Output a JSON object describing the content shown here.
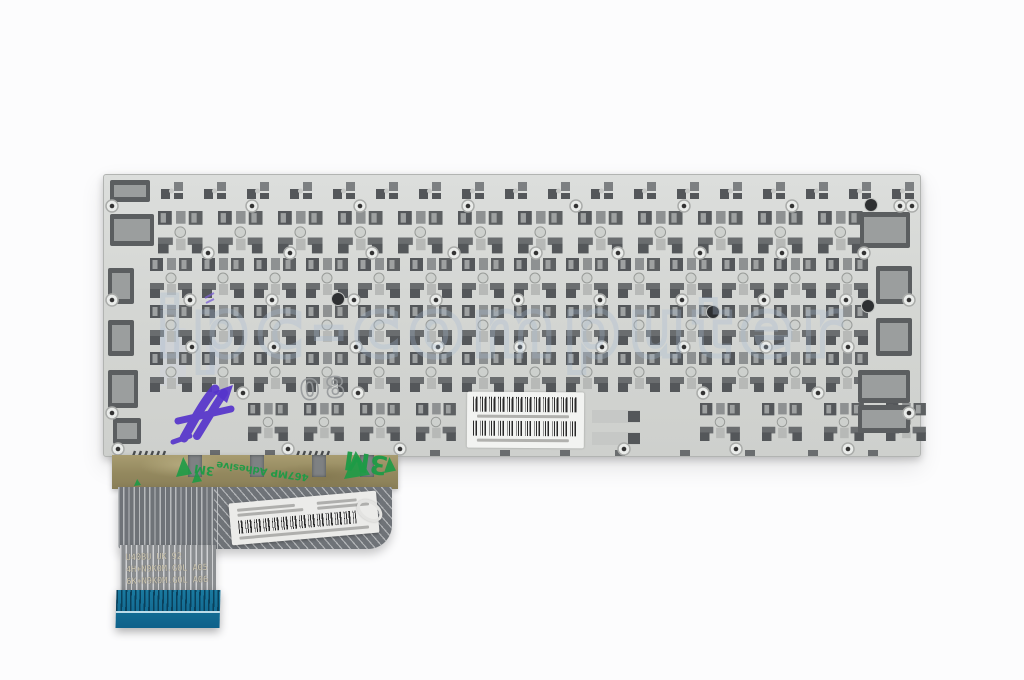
{
  "photo": {
    "subject": "rear side of a laptop keyboard metal backplate with attached ribbon cable",
    "background_color": "#fcfcfd",
    "watermark": {
      "text": "ipc-computer",
      "color": "rgba(165,185,210,0.5)"
    },
    "plate": {
      "x": 103,
      "y": 174,
      "w": 816,
      "h": 281,
      "fill_top": "#dcdedc",
      "fill_bottom": "#ced0cd"
    },
    "stamp": {
      "text": "08",
      "color": "#96999b"
    },
    "handwritten_mark": {
      "description": "purple marker scribble resembling A5",
      "color": "#5634cb"
    },
    "serial_label": {
      "fill": "#f2f3f1",
      "barcode_count": 2
    },
    "tape": {
      "fill": "#93885e",
      "brand": "3M",
      "adhesive_text": "467MP Adhesive",
      "print_color": "#1d9b46"
    },
    "fpc": {
      "fill": "#6f7378",
      "trace_color": "#c3c5c7",
      "connector_color": "#13719c",
      "print_color": "#cfc8b2",
      "print_lines": [
        "U40BU UK 92",
        "4H+N9K0M.G0L A05",
        "6K+N9K0M.G0L A06"
      ],
      "label": {
        "fill": "#ebebe9",
        "has_barcode": true
      }
    }
  },
  "plate_pattern": {
    "colors": {
      "dark": "#54575a",
      "mid": "#6a6d6f",
      "light": "#9ea1a1",
      "slot": "#8e9192",
      "circle": "#cdd0cd",
      "ring": "#989b98",
      "pale": "#b7b9b7",
      "hole_fill": "#e9ebe9",
      "hole_ring": "#aaacaa",
      "hole_dot": "#333333",
      "block": "#5b5e60",
      "block_in": "#9b9e9e",
      "patch": "#cdd2d7"
    },
    "hook_row": {
      "y": 182,
      "startX": 118,
      "pitch": 43,
      "count": 19
    },
    "mech_rows": [
      {
        "y": 211,
        "startX": 158,
        "pitch": 60,
        "count": 12,
        "s": 1.06
      },
      {
        "y": 258,
        "startX": 150,
        "pitch": 52,
        "count": 14,
        "s": 1
      },
      {
        "y": 305,
        "startX": 150,
        "pitch": 52,
        "count": 14,
        "s": 1
      },
      {
        "y": 352,
        "startX": 150,
        "pitch": 52,
        "count": 14,
        "s": 1
      },
      {
        "y": 403,
        "startX": 248,
        "pitch": 56,
        "count": 4,
        "s": 0.95
      },
      {
        "y": 403,
        "startX": 700,
        "pitch": 62,
        "count": 4,
        "s": 0.95
      }
    ],
    "hole_rows": [
      {
        "y": 206,
        "startX": 252,
        "pitch": 108,
        "count": 7
      },
      {
        "y": 253,
        "startX": 208,
        "pitch": 82,
        "count": 9
      },
      {
        "y": 300,
        "startX": 190,
        "pitch": 82,
        "count": 9
      },
      {
        "y": 347,
        "startX": 192,
        "pitch": 82,
        "count": 9
      },
      {
        "y": 393,
        "startX": 243,
        "pitch": 115,
        "count": 6
      },
      {
        "y": 449,
        "startX": 288,
        "pitch": 112,
        "count": 6
      }
    ],
    "edge_holes": [
      [
        112,
        206
      ],
      [
        912,
        206
      ],
      [
        112,
        300
      ],
      [
        909,
        300
      ],
      [
        112,
        413
      ],
      [
        909,
        413
      ],
      [
        118,
        449
      ]
    ],
    "dark_holes": [
      [
        338,
        299
      ],
      [
        713,
        312
      ],
      [
        871,
        205
      ],
      [
        868,
        306
      ]
    ],
    "side_blocks": [
      [
        110,
        180,
        40,
        22
      ],
      [
        110,
        214,
        44,
        32
      ],
      [
        108,
        268,
        26,
        36
      ],
      [
        108,
        320,
        26,
        36
      ],
      [
        108,
        370,
        30,
        38
      ],
      [
        113,
        418,
        28,
        26
      ],
      [
        860,
        212,
        50,
        36
      ],
      [
        876,
        266,
        36,
        38
      ],
      [
        876,
        318,
        36,
        38
      ],
      [
        858,
        370,
        52,
        33
      ],
      [
        858,
        405,
        52,
        28
      ]
    ],
    "space_slots": [
      [
        592,
        410,
        48,
        13
      ],
      [
        592,
        432,
        48,
        13
      ]
    ],
    "bottom_slots": [
      [
        210,
        450,
        10,
        6
      ],
      [
        265,
        450,
        10,
        6
      ],
      [
        430,
        450,
        10,
        6
      ],
      [
        500,
        450,
        10,
        6
      ],
      [
        560,
        450,
        10,
        6
      ],
      [
        615,
        450,
        10,
        6
      ],
      [
        680,
        450,
        10,
        6
      ],
      [
        745,
        450,
        10,
        6
      ],
      [
        808,
        450,
        10,
        6
      ],
      [
        868,
        450,
        10,
        6
      ]
    ],
    "hatch_marks": [
      [
        132,
        451,
        36,
        8
      ],
      [
        296,
        451,
        36,
        8
      ]
    ],
    "light_patches": [
      [
        160,
        328,
        26,
        58
      ],
      [
        206,
        340,
        14,
        34
      ]
    ]
  }
}
